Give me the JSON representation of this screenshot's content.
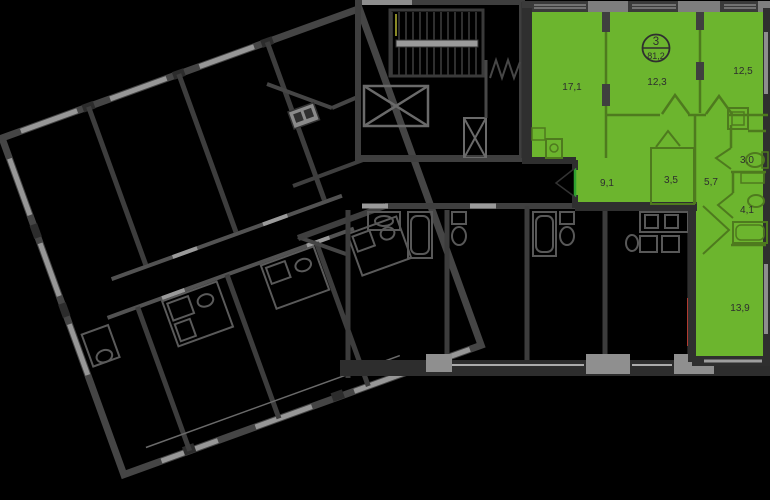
{
  "plan": {
    "type": "floor-plan",
    "highlight_color": "#6cb52e",
    "wall_dark": "#2f2f2f",
    "wall_mid": "#4a4a4a",
    "wall_light": "#949494",
    "badge": {
      "rooms_count": "3",
      "total_area": "81,2"
    },
    "rooms": [
      {
        "name": "room-17-1",
        "area": "17,1"
      },
      {
        "name": "room-12-3",
        "area": "12,3"
      },
      {
        "name": "room-12-5",
        "area": "12,5"
      },
      {
        "name": "hall-9-1",
        "area": "9,1"
      },
      {
        "name": "closet-3-5",
        "area": "3,5"
      },
      {
        "name": "hall-5-7",
        "area": "5,7"
      },
      {
        "name": "bath-3-0",
        "area": "3,0"
      },
      {
        "name": "bath-4-1",
        "area": "4,1"
      },
      {
        "name": "room-13-9",
        "area": "13,9"
      }
    ]
  }
}
